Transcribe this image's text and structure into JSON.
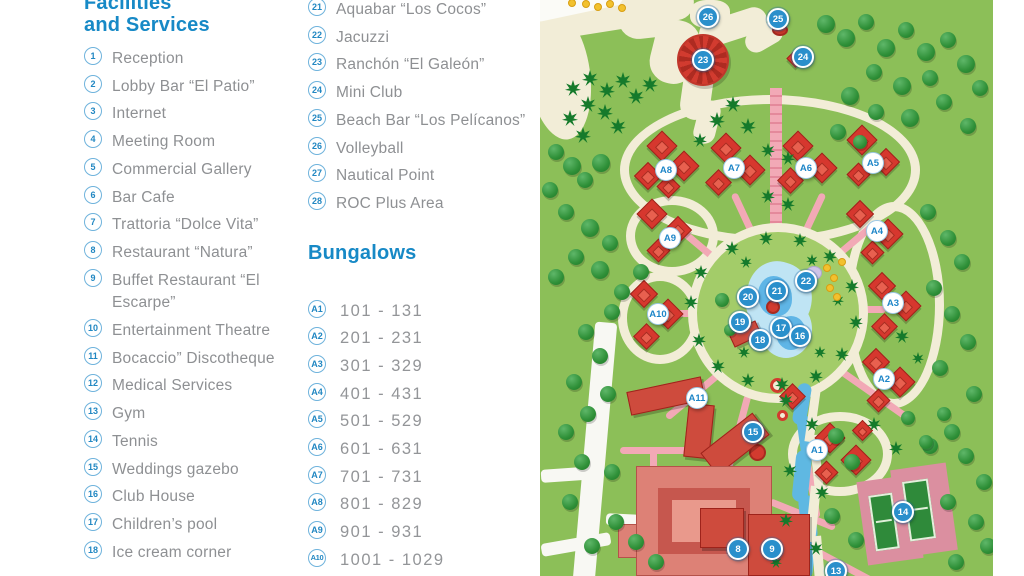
{
  "legend": {
    "facilities_header": {
      "line1": "Facilities",
      "line2": "and Services"
    },
    "facilities": [
      {
        "num": "1",
        "lines": [
          "Reception"
        ]
      },
      {
        "num": "2",
        "lines": [
          "Lobby Bar “El Patio”"
        ]
      },
      {
        "num": "3",
        "lines": [
          "Internet"
        ]
      },
      {
        "num": "4",
        "lines": [
          "Meeting Room"
        ]
      },
      {
        "num": "5",
        "lines": [
          "Commercial Gallery"
        ]
      },
      {
        "num": "6",
        "lines": [
          "Bar Cafe"
        ]
      },
      {
        "num": "7",
        "lines": [
          "Trattoria “Dolce Vita”"
        ]
      },
      {
        "num": "8",
        "lines": [
          "Restaurant “Natura”"
        ]
      },
      {
        "num": "9",
        "lines": [
          "Buffet Restaurant “El",
          "Escarpe”"
        ]
      },
      {
        "num": "10",
        "lines": [
          "Entertainment Theatre"
        ]
      },
      {
        "num": "11",
        "lines": [
          "Bocaccio” Discotheque"
        ]
      },
      {
        "num": "12",
        "lines": [
          "Medical Services"
        ]
      },
      {
        "num": "13",
        "lines": [
          "Gym"
        ]
      },
      {
        "num": "14",
        "lines": [
          "Tennis"
        ]
      },
      {
        "num": "15",
        "lines": [
          "Weddings gazebo"
        ]
      },
      {
        "num": "16",
        "lines": [
          "Club House"
        ]
      },
      {
        "num": "17",
        "lines": [
          "Children’s pool"
        ]
      },
      {
        "num": "18",
        "lines": [
          "Ice cream corner"
        ]
      }
    ],
    "facilities2": [
      {
        "num": "21",
        "lines": [
          "Aquabar “Los Cocos”"
        ]
      },
      {
        "num": "22",
        "lines": [
          "Jacuzzi"
        ]
      },
      {
        "num": "23",
        "lines": [
          "Ranchón “El Galeón”"
        ]
      },
      {
        "num": "24",
        "lines": [
          "Mini Club"
        ]
      },
      {
        "num": "25",
        "lines": [
          "Beach Bar “Los Pelícanos”"
        ]
      },
      {
        "num": "26",
        "lines": [
          "Volleyball"
        ]
      },
      {
        "num": "27",
        "lines": [
          "Nautical Point"
        ]
      },
      {
        "num": "28",
        "lines": [
          "ROC Plus Area"
        ]
      }
    ],
    "bungalows_header": "Bungalows",
    "bungalows": [
      {
        "num": "A1",
        "range": "101 - 131"
      },
      {
        "num": "A2",
        "range": "201 - 231"
      },
      {
        "num": "A3",
        "range": "301 - 329"
      },
      {
        "num": "A4",
        "range": "401 - 431"
      },
      {
        "num": "A5",
        "range": "501 - 529"
      },
      {
        "num": "A6",
        "range": "601 - 631"
      },
      {
        "num": "A7",
        "range": "701 - 731"
      },
      {
        "num": "A8",
        "range": "801 - 829"
      },
      {
        "num": "A9",
        "range": "901 - 931"
      },
      {
        "num": "A10",
        "range": "1001 - 1029"
      }
    ]
  },
  "map": {
    "colors": {
      "grass": "#8CBF58",
      "sand": "#F2EDD7",
      "path_pink": "#F2A9B6",
      "building_red": "#D6372E",
      "hotel_salmon": "#DD8176",
      "pool_blue": "#BFE4F4",
      "marker_blue": "#2A8FCB",
      "header_blue": "#1789C6",
      "legend_gray": "#8E9093"
    },
    "markers": [
      {
        "label": "26",
        "kind": "num",
        "x": 168,
        "y": 17
      },
      {
        "label": "25",
        "kind": "num",
        "x": 238,
        "y": 19
      },
      {
        "label": "24",
        "kind": "num",
        "x": 263,
        "y": 57
      },
      {
        "label": "23",
        "kind": "num",
        "x": 163,
        "y": 60
      },
      {
        "label": "22",
        "kind": "num",
        "x": 266,
        "y": 281
      },
      {
        "label": "21",
        "kind": "num",
        "x": 237,
        "y": 291
      },
      {
        "label": "20",
        "kind": "num",
        "x": 208,
        "y": 297
      },
      {
        "label": "19",
        "kind": "num",
        "x": 200,
        "y": 322
      },
      {
        "label": "17",
        "kind": "num",
        "x": 241,
        "y": 328
      },
      {
        "label": "18",
        "kind": "num",
        "x": 220,
        "y": 340
      },
      {
        "label": "16",
        "kind": "num",
        "x": 260,
        "y": 336
      },
      {
        "label": "15",
        "kind": "num",
        "x": 213,
        "y": 432
      },
      {
        "label": "8",
        "kind": "num",
        "x": 198,
        "y": 549
      },
      {
        "label": "9",
        "kind": "num",
        "x": 232,
        "y": 549
      },
      {
        "label": "13",
        "kind": "num",
        "x": 296,
        "y": 571
      },
      {
        "label": "14",
        "kind": "num",
        "x": 363,
        "y": 512
      },
      {
        "label": "A8",
        "kind": "letter",
        "x": 126,
        "y": 170
      },
      {
        "label": "A7",
        "kind": "letter",
        "x": 194,
        "y": 168
      },
      {
        "label": "A6",
        "kind": "letter",
        "x": 266,
        "y": 168
      },
      {
        "label": "A5",
        "kind": "letter",
        "x": 333,
        "y": 163
      },
      {
        "label": "A4",
        "kind": "letter",
        "x": 337,
        "y": 231
      },
      {
        "label": "A9",
        "kind": "letter",
        "x": 130,
        "y": 238
      },
      {
        "label": "A3",
        "kind": "letter",
        "x": 353,
        "y": 303
      },
      {
        "label": "A10",
        "kind": "letter",
        "x": 118,
        "y": 314
      },
      {
        "label": "A2",
        "kind": "letter",
        "x": 344,
        "y": 379
      },
      {
        "label": "A11",
        "kind": "letter",
        "x": 157,
        "y": 398
      },
      {
        "label": "A1",
        "kind": "letter",
        "x": 277,
        "y": 450
      }
    ],
    "houses": [
      [
        122,
        146,
        22
      ],
      [
        144,
        166,
        22
      ],
      [
        108,
        176,
        20
      ],
      [
        128,
        186,
        17
      ],
      [
        186,
        148,
        22
      ],
      [
        210,
        170,
        22
      ],
      [
        178,
        182,
        19
      ],
      [
        258,
        146,
        22
      ],
      [
        282,
        168,
        22
      ],
      [
        250,
        180,
        19
      ],
      [
        322,
        140,
        22
      ],
      [
        346,
        162,
        20
      ],
      [
        318,
        174,
        17
      ],
      [
        320,
        214,
        20
      ],
      [
        348,
        234,
        22
      ],
      [
        332,
        252,
        17
      ],
      [
        112,
        214,
        22
      ],
      [
        138,
        230,
        20
      ],
      [
        118,
        250,
        17
      ],
      [
        342,
        286,
        20
      ],
      [
        366,
        306,
        22
      ],
      [
        344,
        326,
        19
      ],
      [
        104,
        294,
        20
      ],
      [
        128,
        314,
        22
      ],
      [
        106,
        336,
        19
      ],
      [
        336,
        362,
        20
      ],
      [
        360,
        382,
        22
      ],
      [
        338,
        400,
        17
      ],
      [
        290,
        438,
        22
      ],
      [
        316,
        460,
        22
      ],
      [
        286,
        472,
        17
      ],
      [
        322,
        430,
        15
      ],
      [
        252,
        396,
        19
      ],
      [
        255,
        58,
        13
      ]
    ],
    "trees": [
      [
        33,
        88,
        8,
        "p"
      ],
      [
        50,
        78,
        8,
        "p"
      ],
      [
        67,
        90,
        8,
        "p"
      ],
      [
        83,
        80,
        8,
        "p"
      ],
      [
        48,
        104,
        8,
        "p"
      ],
      [
        65,
        112,
        8,
        "p"
      ],
      [
        30,
        118,
        8,
        "p"
      ],
      [
        96,
        96,
        8,
        "p"
      ],
      [
        110,
        84,
        8,
        "p"
      ],
      [
        78,
        126,
        8,
        "p"
      ],
      [
        43,
        135,
        8,
        "p"
      ],
      [
        16,
        152,
        8,
        "b"
      ],
      [
        32,
        166,
        9,
        "b"
      ],
      [
        10,
        190,
        8,
        "b"
      ],
      [
        45,
        180,
        8,
        "b"
      ],
      [
        61,
        163,
        9,
        "b"
      ],
      [
        26,
        212,
        8,
        "b"
      ],
      [
        50,
        228,
        9,
        "b"
      ],
      [
        70,
        243,
        8,
        "b"
      ],
      [
        36,
        257,
        8,
        "b"
      ],
      [
        16,
        277,
        8,
        "b"
      ],
      [
        60,
        270,
        9,
        "b"
      ],
      [
        82,
        292,
        8,
        "b"
      ],
      [
        101,
        272,
        8,
        "b"
      ],
      [
        72,
        312,
        8,
        "b"
      ],
      [
        177,
        120,
        8,
        "p"
      ],
      [
        193,
        104,
        8,
        "p"
      ],
      [
        208,
        126,
        8,
        "p"
      ],
      [
        160,
        140,
        7,
        "p"
      ],
      [
        228,
        150,
        7,
        "p"
      ],
      [
        248,
        158,
        7,
        "p"
      ],
      [
        228,
        196,
        7,
        "p"
      ],
      [
        248,
        204,
        7,
        "p"
      ],
      [
        286,
        24,
        9,
        "b"
      ],
      [
        306,
        38,
        9,
        "b"
      ],
      [
        326,
        22,
        8,
        "b"
      ],
      [
        346,
        48,
        9,
        "b"
      ],
      [
        366,
        30,
        8,
        "b"
      ],
      [
        386,
        52,
        9,
        "b"
      ],
      [
        408,
        40,
        8,
        "b"
      ],
      [
        426,
        64,
        9,
        "b"
      ],
      [
        390,
        78,
        8,
        "b"
      ],
      [
        362,
        86,
        9,
        "b"
      ],
      [
        334,
        72,
        8,
        "b"
      ],
      [
        310,
        96,
        9,
        "b"
      ],
      [
        336,
        112,
        8,
        "b"
      ],
      [
        370,
        118,
        9,
        "b"
      ],
      [
        404,
        102,
        8,
        "b"
      ],
      [
        428,
        126,
        8,
        "b"
      ],
      [
        440,
        88,
        8,
        "b"
      ],
      [
        298,
        132,
        8,
        "b"
      ],
      [
        320,
        142,
        7,
        "b"
      ],
      [
        388,
        212,
        8,
        "b"
      ],
      [
        408,
        238,
        8,
        "b"
      ],
      [
        422,
        262,
        8,
        "b"
      ],
      [
        394,
        288,
        8,
        "b"
      ],
      [
        412,
        314,
        8,
        "b"
      ],
      [
        428,
        342,
        8,
        "b"
      ],
      [
        400,
        368,
        8,
        "b"
      ],
      [
        434,
        394,
        8,
        "b"
      ],
      [
        161,
        272,
        7,
        "p"
      ],
      [
        151,
        302,
        7,
        "p"
      ],
      [
        159,
        340,
        7,
        "p"
      ],
      [
        178,
        366,
        7,
        "p"
      ],
      [
        208,
        380,
        7,
        "p"
      ],
      [
        242,
        384,
        7,
        "p"
      ],
      [
        276,
        376,
        7,
        "p"
      ],
      [
        302,
        354,
        7,
        "p"
      ],
      [
        316,
        322,
        7,
        "p"
      ],
      [
        312,
        286,
        7,
        "p"
      ],
      [
        290,
        256,
        7,
        "p"
      ],
      [
        260,
        240,
        7,
        "p"
      ],
      [
        226,
        238,
        7,
        "p"
      ],
      [
        192,
        248,
        7,
        "p"
      ],
      [
        206,
        262,
        6,
        "p"
      ],
      [
        272,
        260,
        6,
        "p"
      ],
      [
        298,
        300,
        6,
        "p"
      ],
      [
        204,
        352,
        6,
        "p"
      ],
      [
        280,
        352,
        6,
        "p"
      ],
      [
        182,
        300,
        7,
        "b"
      ],
      [
        190,
        330,
        6,
        "b"
      ],
      [
        46,
        332,
        8,
        "b"
      ],
      [
        60,
        356,
        8,
        "b"
      ],
      [
        34,
        382,
        8,
        "b"
      ],
      [
        68,
        394,
        8,
        "b"
      ],
      [
        48,
        414,
        8,
        "b"
      ],
      [
        26,
        432,
        8,
        "b"
      ],
      [
        42,
        462,
        8,
        "b"
      ],
      [
        72,
        472,
        8,
        "b"
      ],
      [
        30,
        502,
        8,
        "b"
      ],
      [
        76,
        522,
        8,
        "b"
      ],
      [
        52,
        546,
        8,
        "b"
      ],
      [
        96,
        542,
        8,
        "b"
      ],
      [
        116,
        562,
        8,
        "b"
      ],
      [
        246,
        400,
        7,
        "p"
      ],
      [
        272,
        424,
        7,
        "p"
      ],
      [
        250,
        470,
        7,
        "p"
      ],
      [
        282,
        492,
        7,
        "p"
      ],
      [
        246,
        520,
        7,
        "p"
      ],
      [
        276,
        548,
        7,
        "p"
      ],
      [
        236,
        562,
        6,
        "p"
      ],
      [
        296,
        436,
        8,
        "b"
      ],
      [
        312,
        462,
        8,
        "b"
      ],
      [
        292,
        516,
        8,
        "b"
      ],
      [
        316,
        540,
        8,
        "b"
      ],
      [
        412,
        432,
        8,
        "b"
      ],
      [
        426,
        456,
        8,
        "b"
      ],
      [
        444,
        482,
        8,
        "b"
      ],
      [
        408,
        502,
        8,
        "b"
      ],
      [
        436,
        522,
        8,
        "b"
      ],
      [
        448,
        546,
        8,
        "b"
      ],
      [
        416,
        562,
        8,
        "b"
      ],
      [
        390,
        446,
        8,
        "b"
      ],
      [
        362,
        336,
        7,
        "p"
      ],
      [
        378,
        358,
        6,
        "p"
      ],
      [
        368,
        418,
        7,
        "b"
      ],
      [
        386,
        442,
        7,
        "b"
      ],
      [
        404,
        414,
        7,
        "b"
      ],
      [
        334,
        424,
        7,
        "p"
      ],
      [
        356,
        448,
        7,
        "p"
      ]
    ],
    "umbrellas": [
      [
        46,
        4
      ],
      [
        58,
        7
      ],
      [
        70,
        4
      ],
      [
        82,
        8
      ],
      [
        32,
        3
      ],
      [
        287,
        268
      ],
      [
        294,
        278
      ],
      [
        290,
        288
      ],
      [
        297,
        297
      ],
      [
        302,
        262
      ]
    ]
  }
}
